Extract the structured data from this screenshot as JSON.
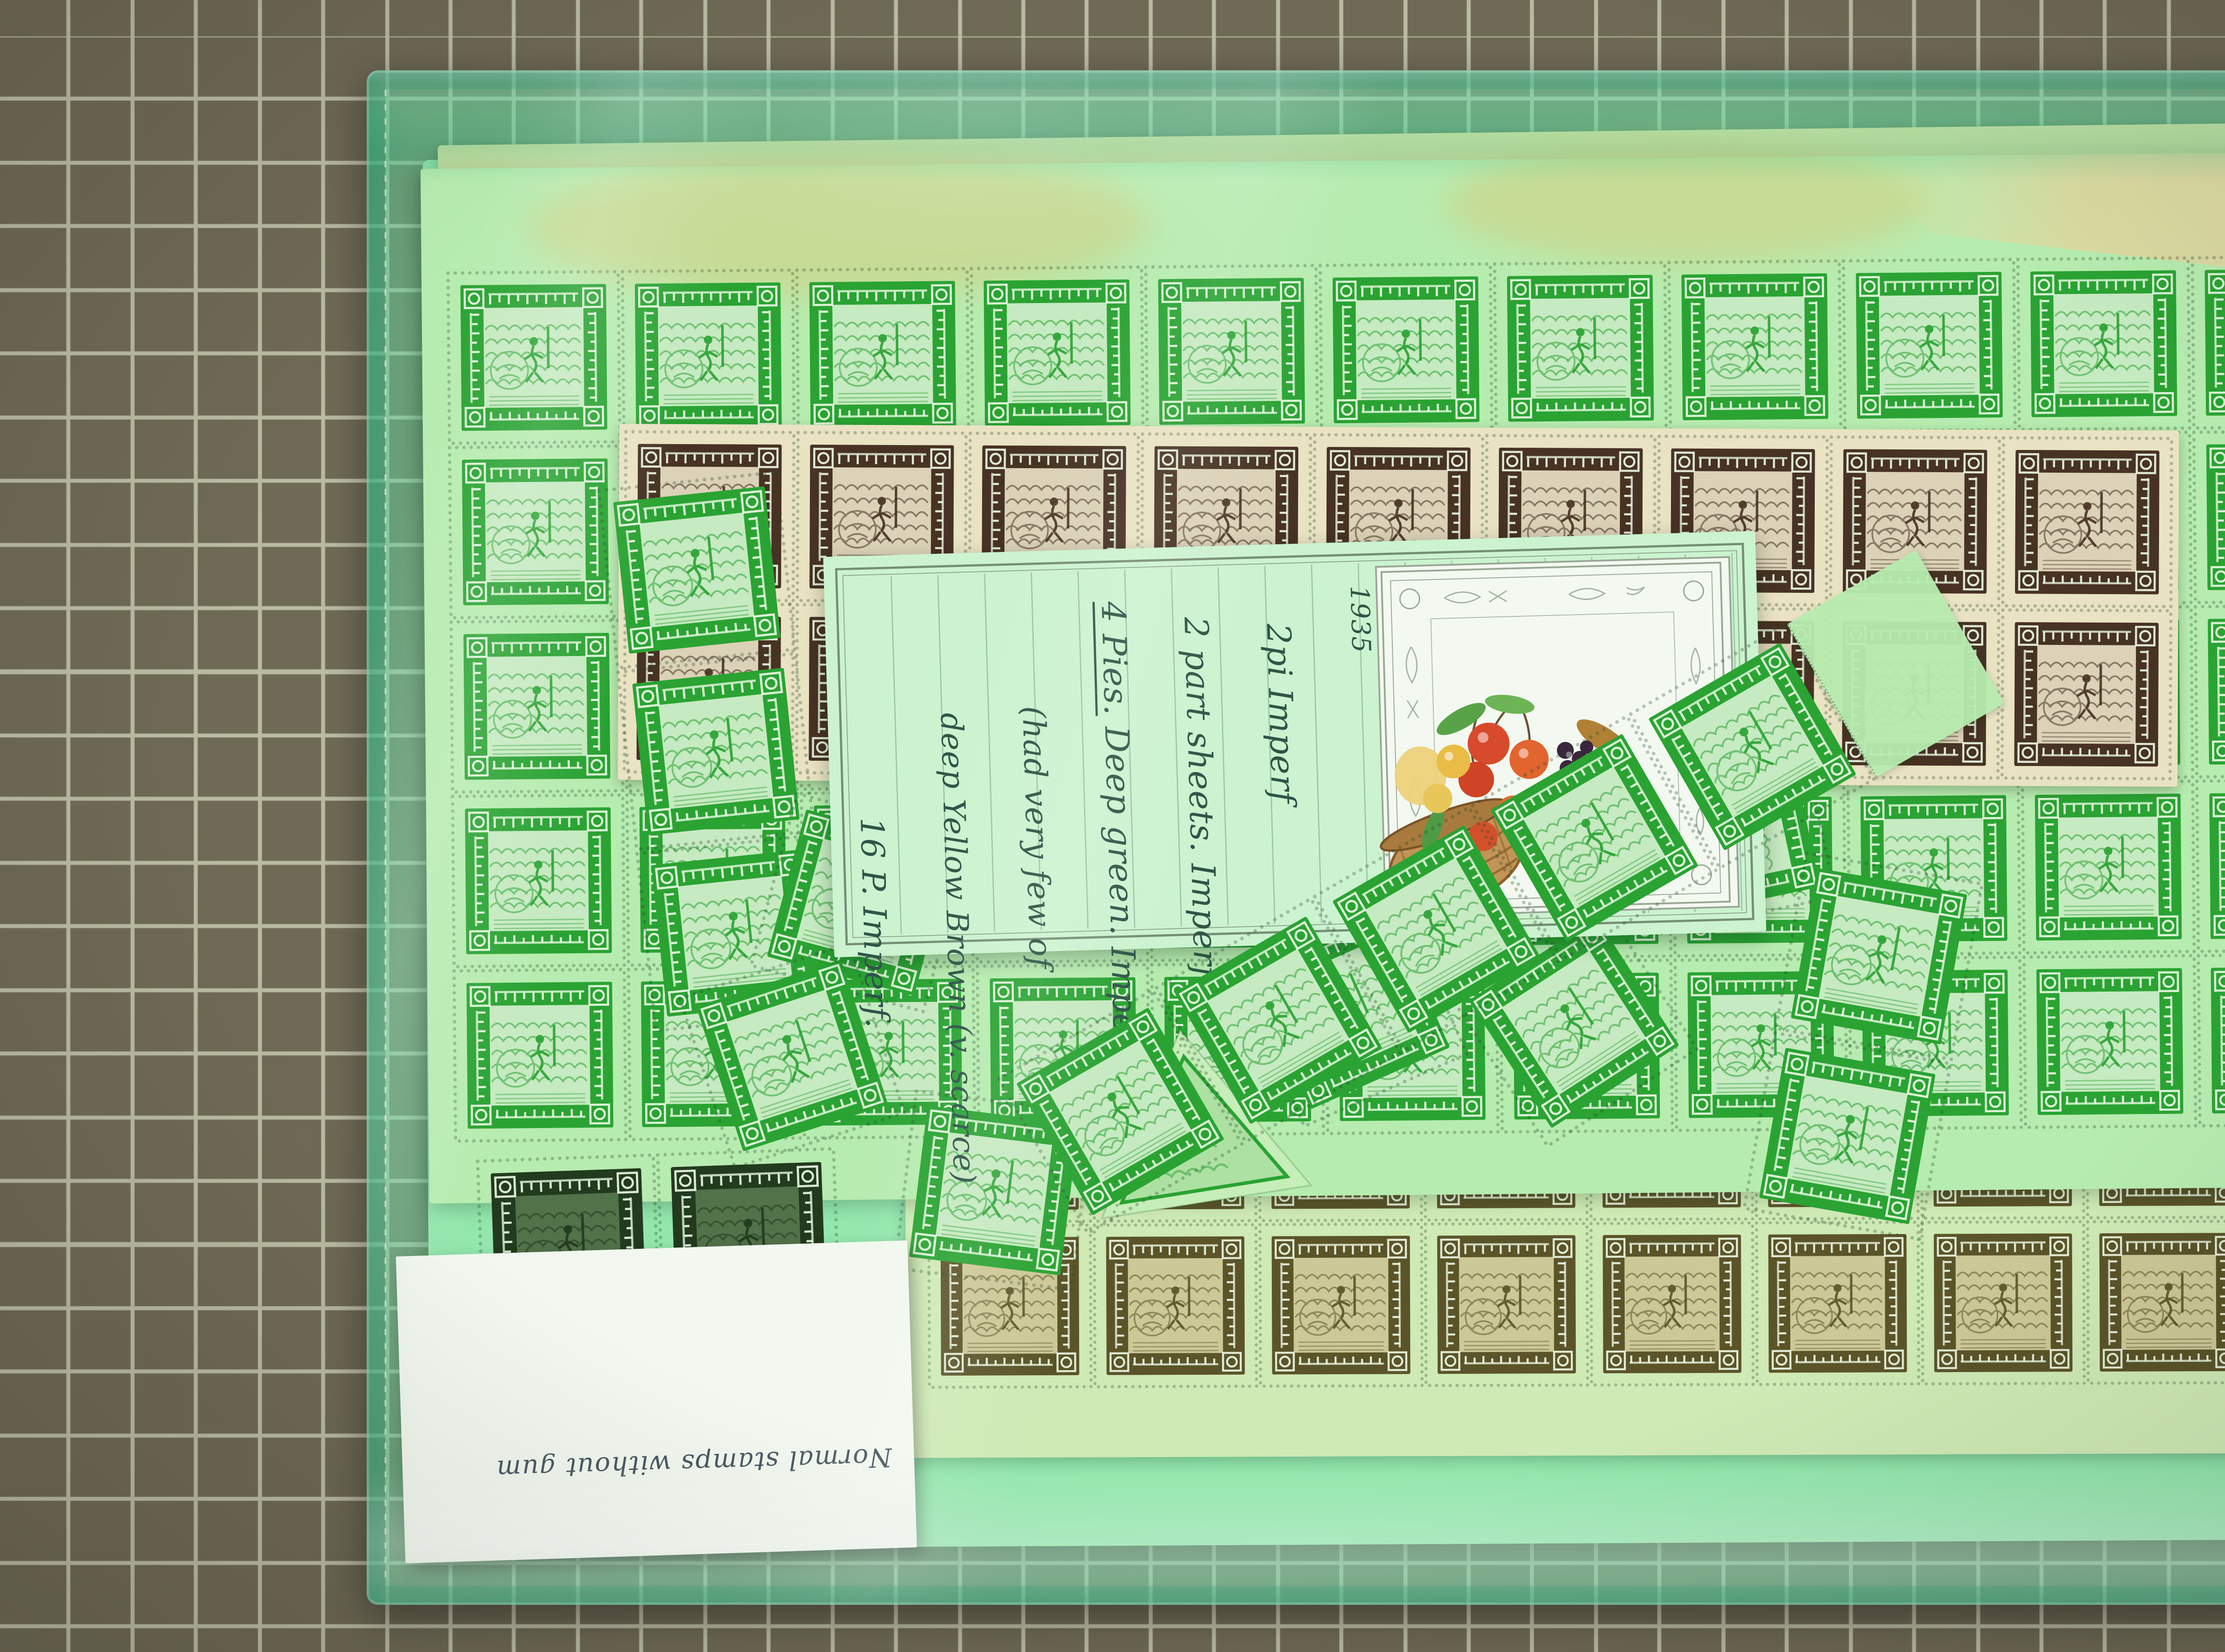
{
  "scene": {
    "description": "Photograph of sheets of 1935 Nepal pictorial postage stamps (green, brown and olive printings with Devanagari inscriptions) stored in a translucent green plastic sleeve, lying on an olive cutting mat with a white grid; a handwritten dealer note card with a chromolithograph fruit-basket vignette sits on the sheets and a small white label lies at lower left",
    "palette": {
      "mat": "#6f6a55",
      "mat-line": "#babba3",
      "paper-back": "#93e7ad",
      "paper-green": "#b7ecb0",
      "paper-cream": "#e9e3c3",
      "paper-olive": "#cfeab5",
      "ink-green": "#2aa333",
      "ink-brown": "#473223",
      "ink-olive": "#5b5429",
      "ink-dark": "#223a1e",
      "card": "#ccf3d0",
      "card-ink": "#2e5547",
      "label": "#f2f8ef",
      "label-ink": "#4a5a63",
      "lite": "rgba(238,252,232,0.9)",
      "perf": "rgba(35,70,40,0.30)"
    },
    "stamp_design": {
      "type": "square pictorial, deity with spear on mountain background",
      "inscription_script": "Devanagari",
      "frame": "dark band with light script characters, rosette corner boxes, pin-perforated edges"
    },
    "sheets": {
      "green_sheet": {
        "ink": "green",
        "columns": 11,
        "rows": 5
      },
      "brown_block": {
        "ink": "dark brown",
        "columns": 9,
        "rows": 2
      },
      "olive_sheet": {
        "ink": "olive brown",
        "columns": 9,
        "rows": 2
      },
      "dark_pair": {
        "ink": "blackish green",
        "columns": 2,
        "rows": 1
      },
      "loose_green_stamps": 13
    }
  },
  "note_card": {
    "year": "1935",
    "lines": [
      "1935",
      "2pi Imperf",
      "2 part sheets. Imperf.",
      "4 Pies. Deep green. Imperf.",
      "(had very few of",
      "deep Yellow Brown (v. scarce)",
      "16 P. Imperf."
    ],
    "illustration": "basket of fruit chromolithograph with engraved leaf border"
  },
  "white_label": {
    "text": "Normal stamps without gum",
    "orientation": "upside-down"
  }
}
